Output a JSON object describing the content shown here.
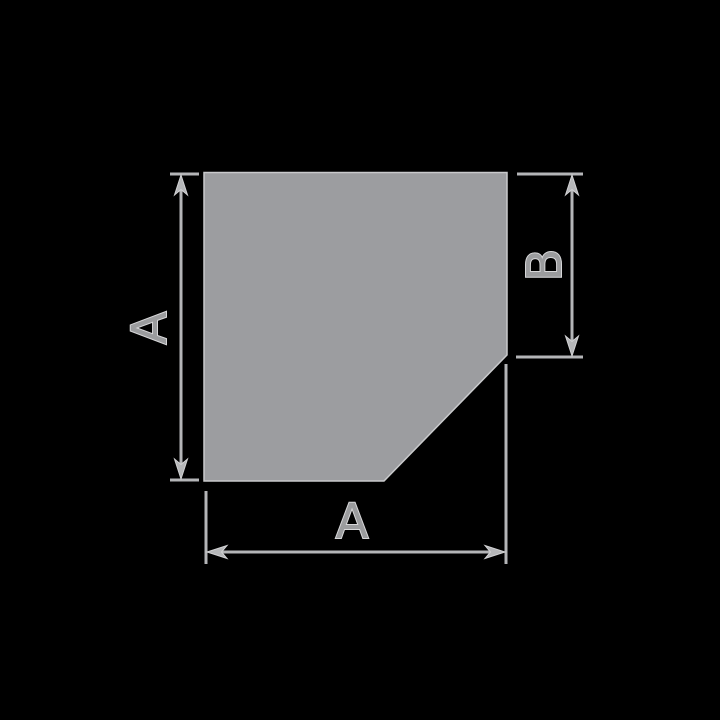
{
  "diagram": {
    "left_dimension": {
      "label": "A"
    },
    "right_dimension": {
      "label": "B"
    },
    "bottom_dimension": {
      "label": "A"
    }
  },
  "colors": {
    "background": "#000000",
    "shape_fill": "#9c9da0",
    "shape_edge_highlight": "#c9cacc",
    "dimension_line": "#b4b5b7",
    "arrowhead_fill": "#b6b7b9",
    "label_text_fill": "#9b9c9e",
    "label_text_outline": "#d7d7d9"
  }
}
